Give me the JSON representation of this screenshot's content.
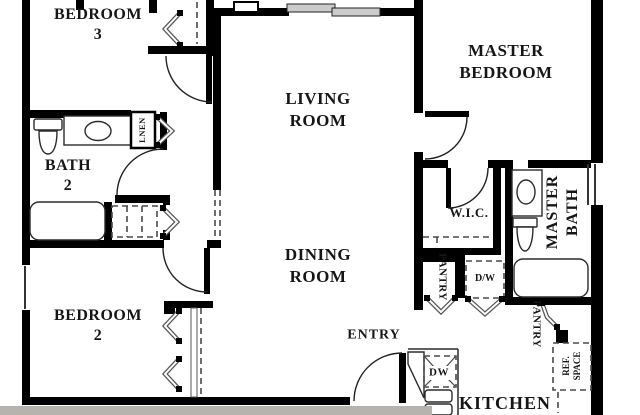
{
  "floorplan": {
    "rooms": {
      "bedroom3": {
        "line1": "BEDROOM",
        "line2": "3"
      },
      "bath2": {
        "line1": "BATH",
        "line2": "2"
      },
      "bedroom2": {
        "line1": "BEDROOM",
        "line2": "2"
      },
      "living": {
        "line1": "LIVING",
        "line2": "ROOM"
      },
      "dining": {
        "line1": "DINING",
        "line2": "ROOM"
      },
      "master_bedroom": {
        "line1": "MASTER",
        "line2": "BEDROOM"
      },
      "master_bath": {
        "line1": "MASTER",
        "line2": "BATH"
      },
      "wic": {
        "label": "W.I.C."
      },
      "entry": {
        "label": "ENTRY"
      },
      "kitchen": {
        "label": "KITCHEN"
      }
    },
    "closets": {
      "linen": {
        "label": "LNEN"
      },
      "pantry_left": {
        "label": "PANTRY"
      },
      "pantry_right": {
        "label": "PANTRY"
      },
      "laundry": {
        "label": "D/W"
      },
      "dishwasher": {
        "label": "DW"
      },
      "ref_space": {
        "line1": "REF.",
        "line2": "SPACE"
      }
    },
    "colors": {
      "wall": "#000000",
      "fixture_line": "#2b2b2b",
      "dashed_line": "#4a4a4a",
      "glass_panel": "#cccccc",
      "photo_edge": "#b5b3ae",
      "background": "#ffffff"
    }
  }
}
